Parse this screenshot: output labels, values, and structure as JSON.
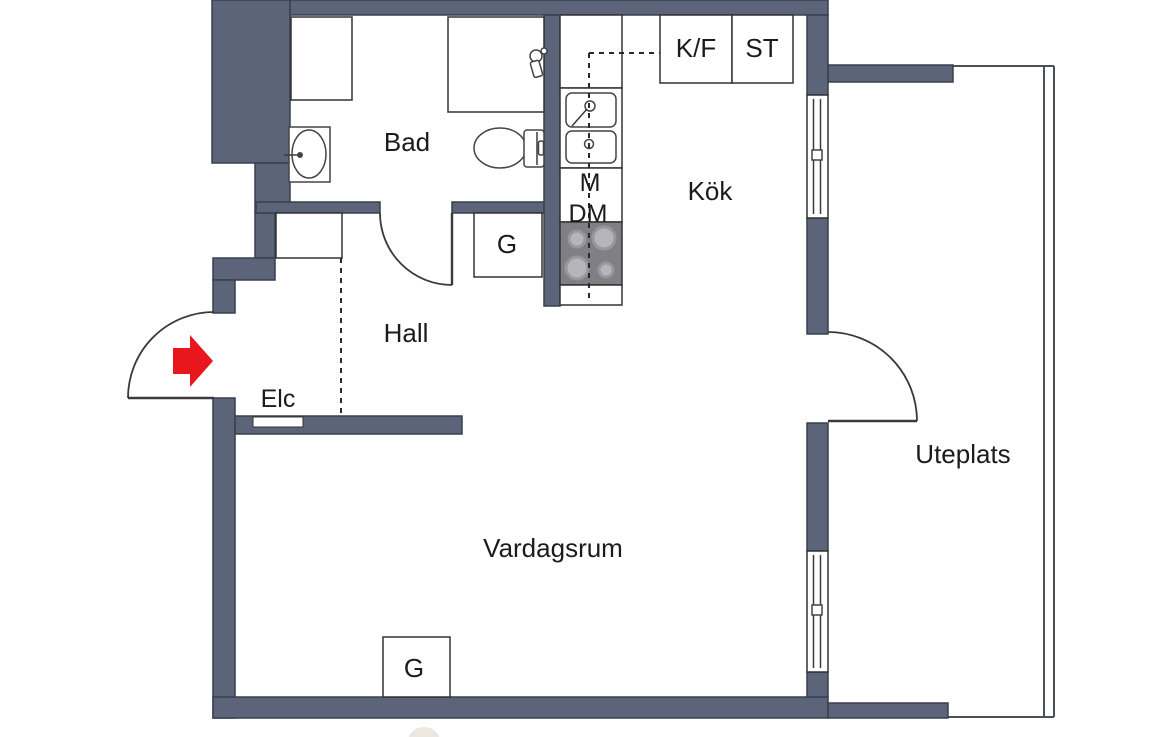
{
  "floorplan": {
    "labels": {
      "bad": "Bad",
      "kok": "Kök",
      "hall": "Hall",
      "vardagsrum": "Vardagsrum",
      "uteplats": "Uteplats",
      "elc": "Elc",
      "kf": "K/F",
      "st": "ST",
      "m": "M",
      "dm": "DM",
      "g_hall": "G",
      "g_vardagsrum": "G"
    },
    "colors": {
      "wall": "#5b6478",
      "wall_outline": "#39404f",
      "interior_line": "#3a3a3a",
      "stove": "#7f7f85",
      "burner": "#b5b5ba",
      "entrance_arrow": "#e8171d",
      "text": "#1b1b1b",
      "background": "#ffffff"
    }
  }
}
